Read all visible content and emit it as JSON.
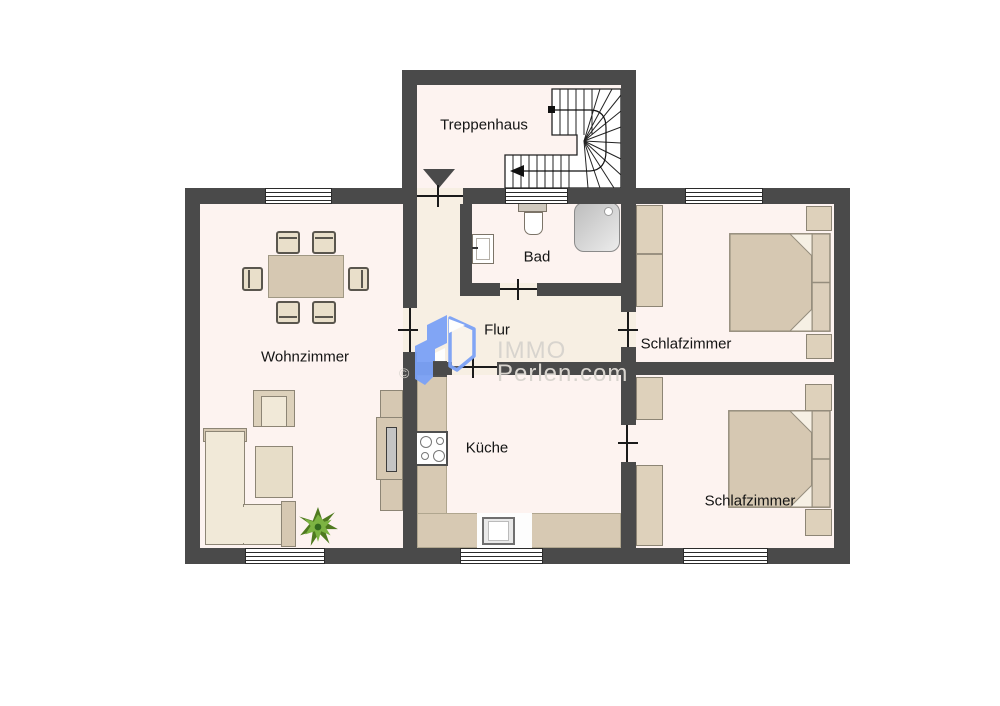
{
  "rooms": {
    "treppenhaus": {
      "label": "Treppenhaus"
    },
    "bad": {
      "label": "Bad"
    },
    "flur": {
      "label": "Flur"
    },
    "wohnzimmer": {
      "label": "Wohnzimmer"
    },
    "kueche": {
      "label": "Küche"
    },
    "schlafzimmer_top": {
      "label": "Schlafzimmer"
    },
    "schlafzimmer_bottom": {
      "label": "Schlafzimmer"
    }
  },
  "watermark": {
    "brand_top": "IMMO",
    "brand_bottom": "Perlen.com",
    "copyright_symbol": "©"
  },
  "colors": {
    "wall": "#4a4a4a",
    "floor": "#fdf3f0",
    "hall_floor": "#f7efe3",
    "furniture": "#d6c8b2",
    "furniture_light": "#f1e9d8",
    "counter": "#d7c9b3",
    "logo_blue": "#7ba2f7",
    "watermark_text": "#d8d4ce"
  }
}
